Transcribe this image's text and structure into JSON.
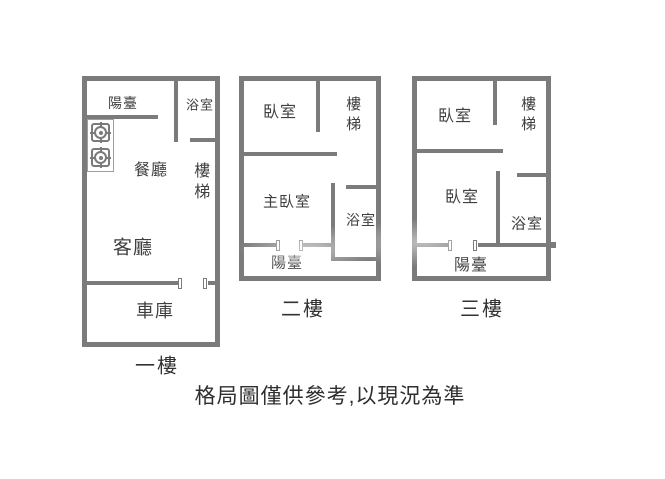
{
  "colors": {
    "wall": "#7b7b7b",
    "room_text": "#3f3f3f",
    "floor_text": "#333333",
    "disclaimer_text": "#2e2e2e"
  },
  "floor1": {
    "label": "一樓",
    "balcony": "陽臺",
    "bathroom": "浴室",
    "dining": "餐廳",
    "stairs": "樓梯",
    "living": "客廳",
    "garage": "車庫"
  },
  "floor2": {
    "label": "二樓",
    "bedroom": "臥室",
    "stairs": "樓梯",
    "master_bedroom": "主臥室",
    "bathroom": "浴室",
    "balcony": "陽臺"
  },
  "floor3": {
    "label": "三樓",
    "bedroom_top": "臥室",
    "stairs": "樓梯",
    "bedroom": "臥室",
    "bathroom": "浴室",
    "balcony": "陽臺"
  },
  "disclaimer": "格局圖僅供參考,以現況為準"
}
